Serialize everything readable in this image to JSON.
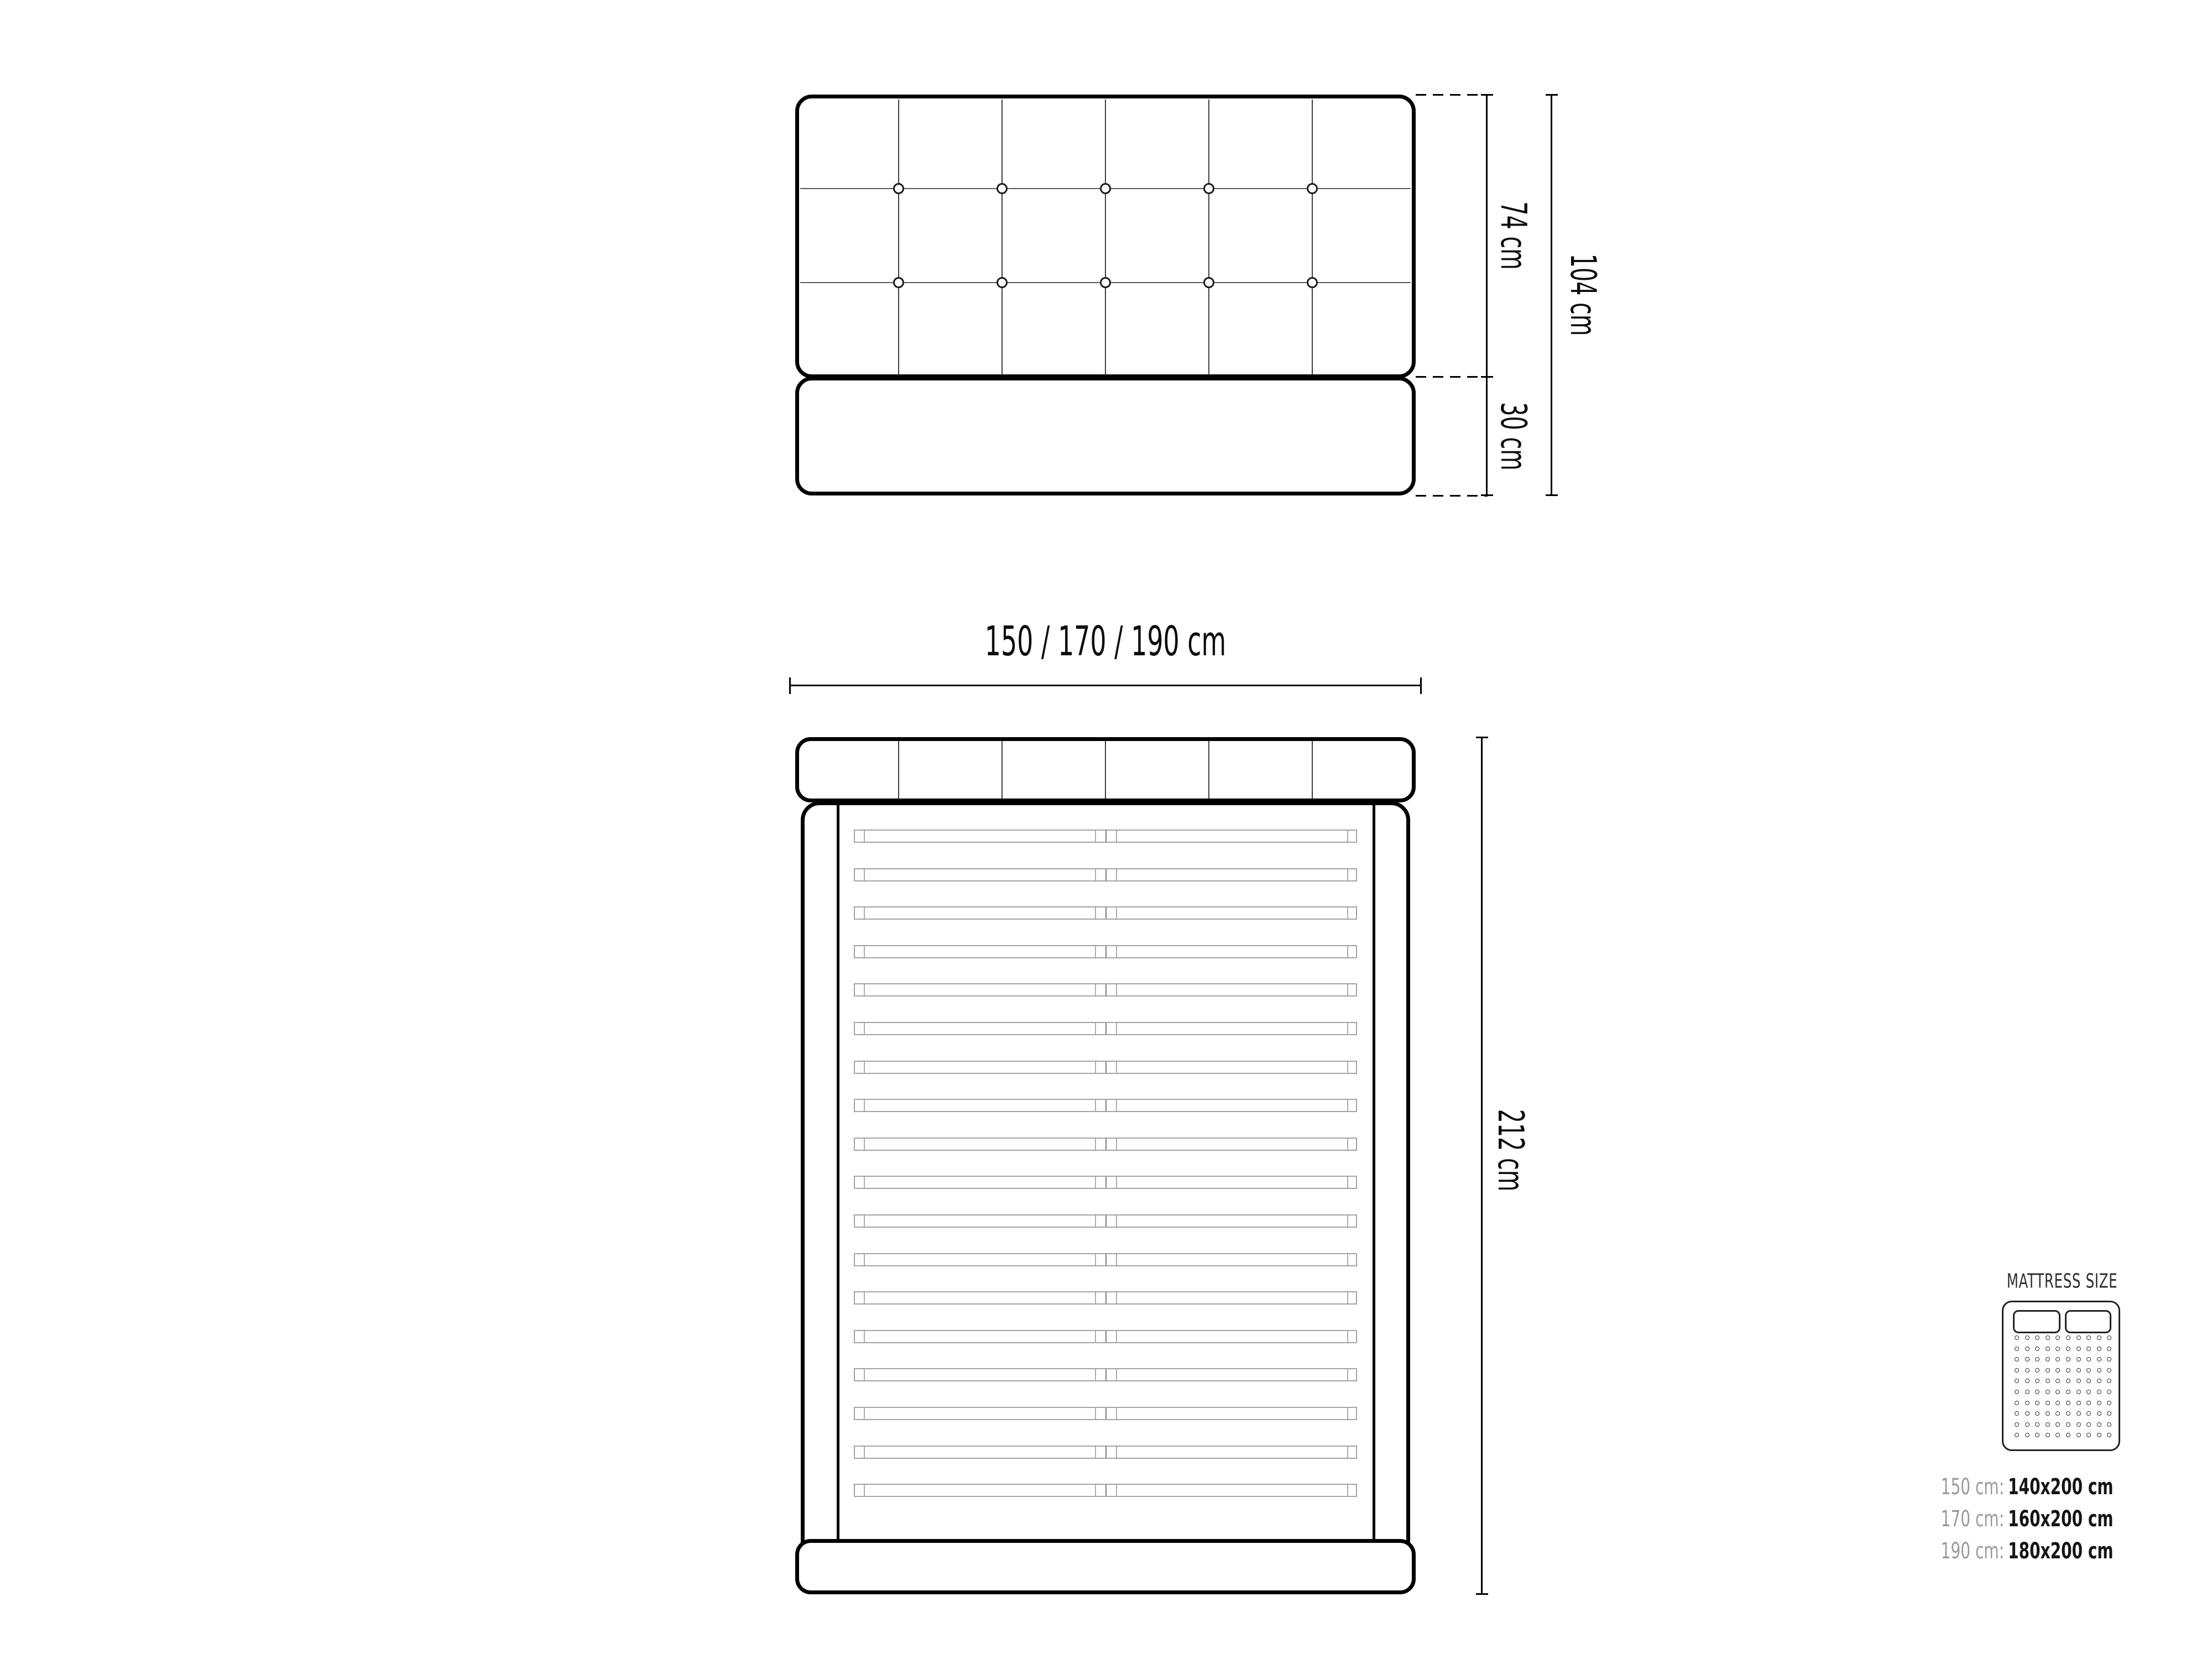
{
  "diagram_title": "bed technical drawing",
  "front_view": {
    "description": "front elevation of upholstered bed headboard with base",
    "headboard_columns": 6,
    "tuft_line_rows": 2,
    "buttons_per_row": 5,
    "dims": {
      "headboard_height": "74 cm",
      "base_height": "30 cm",
      "total_height": "104 cm"
    }
  },
  "top_view": {
    "description": "top view of bed frame with slats",
    "width_label": "150 / 170 / 190  cm",
    "length_label": "212 cm",
    "headboard_sections": 6,
    "slat_count": 18
  },
  "legend": {
    "title": "MATTRESS SIZE",
    "rows": [
      {
        "frame": "150 cm:",
        "mattress": "140x200 cm"
      },
      {
        "frame": "170 cm:",
        "mattress": "160x200 cm"
      },
      {
        "frame": "190 cm:",
        "mattress": "180x200 cm"
      }
    ],
    "dot_grid": {
      "cols": 10,
      "rows": 10
    }
  },
  "colors": {
    "ink": "#000000",
    "grid_line": "#3f3f3f",
    "tuft_line": "#5c5c5c",
    "slat_line": "#a3a3a3",
    "legend_gray": "#9b9b9b",
    "legend_dark": "#151515",
    "background": "#ffffff"
  }
}
